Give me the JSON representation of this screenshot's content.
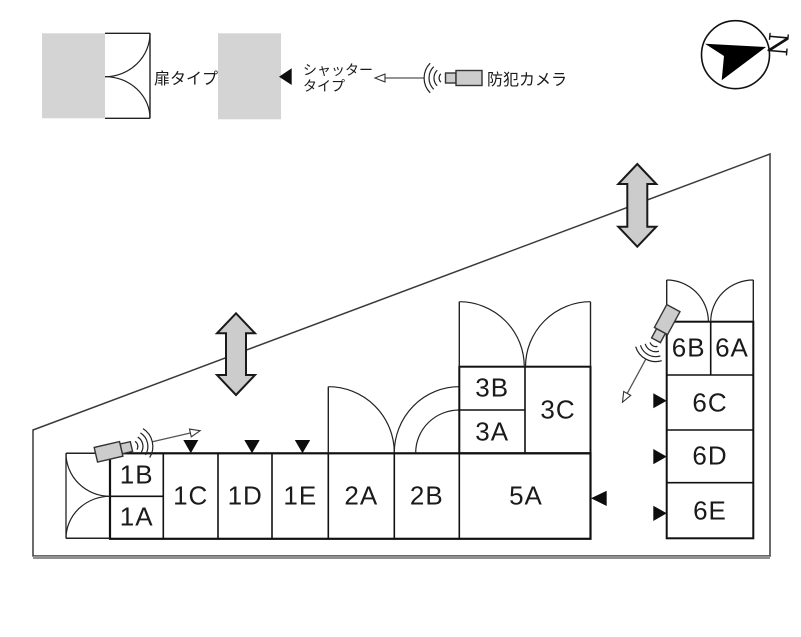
{
  "legend": {
    "door_type": "扉タイプ",
    "shutter_type_line1": "シャッター",
    "shutter_type_line2": "タイプ",
    "security_camera": "防犯カメラ"
  },
  "compass": {
    "north": "N"
  },
  "units": {
    "u1A": "1A",
    "u1B": "1B",
    "u1C": "1C",
    "u1D": "1D",
    "u1E": "1E",
    "u2A": "2A",
    "u2B": "2B",
    "u3A": "3A",
    "u3B": "3B",
    "u3C": "3C",
    "u5A": "5A",
    "u6A": "6A",
    "u6B": "6B",
    "u6C": "6C",
    "u6D": "6D",
    "u6E": "6E"
  },
  "colors": {
    "legend_box_fill": "#d4d4d4",
    "double_arrow_fill": "#cccccc",
    "camera_fill": "#cccccc",
    "line": "#1a1a1a"
  }
}
